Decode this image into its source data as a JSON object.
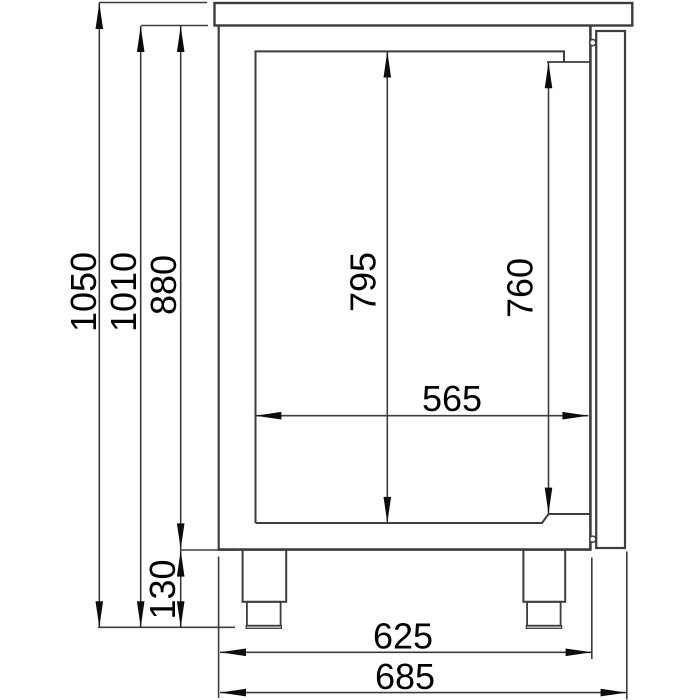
{
  "drawing": {
    "background": "#ffffff",
    "line_color": "#3d3d3d",
    "arrow_color": "#0c0c0c",
    "text_color": "#000000",
    "dimension_labels": {
      "overall_height": "1050",
      "height_under_counter": "1010",
      "body_height": "880",
      "interior_height": "795",
      "interior_height_at_door": "760",
      "interior_depth": "565",
      "leg_height": "130",
      "body_depth": "625",
      "overall_depth": "685"
    }
  }
}
